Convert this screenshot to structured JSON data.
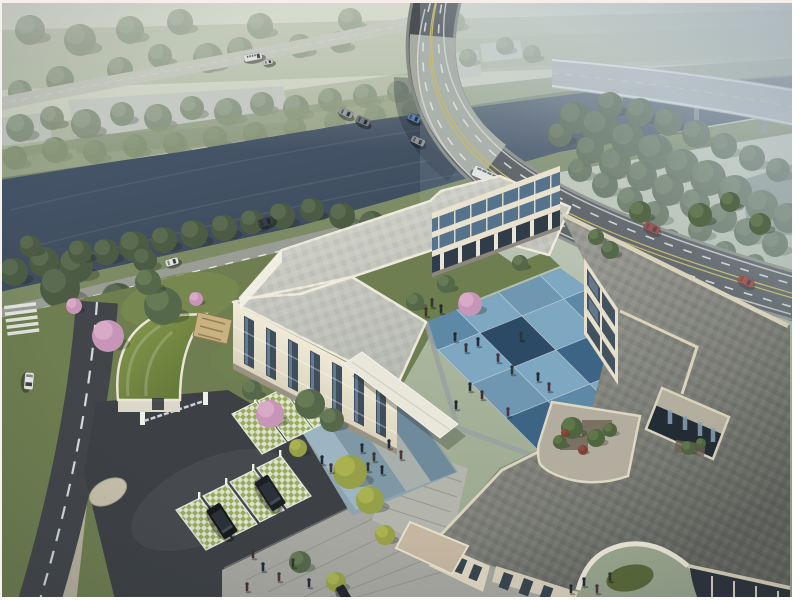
{
  "meta": {
    "alt": "Aerial daytime architectural rendering: cream three-storey U-shaped building complex around a blue checkerboard courtyard with roof terraces and a square atrium, landscaped gated entrance with grass-grid parking and black SUVs, tree-lined river crossed by a traffic bridge, curved elevated expressway fading into haze",
    "image_type": "photorealistic 3D rendering",
    "frame_color": "#ffffff"
  },
  "palette": {
    "sky_top": "#d8dacd",
    "haze": "#bccbd6",
    "water": "#45556a",
    "tree_green": "#57684b",
    "tree_dark": "#46563e",
    "tree_hazy": "#7b8b74",
    "tree_yellow": "#96a048",
    "blossom_pink": "#cc9cbd",
    "lawn": "#6e7e50",
    "asphalt_dark": "#3d4145",
    "road_asphalt": "#4c5053",
    "bridge_deck": "#a7aba3",
    "road_line_yellow": "#c9b84e",
    "road_line_white": "#e8e9e5",
    "building_cream": "#e8e2cf",
    "roof_west": "#c9cbc2",
    "roof_right": "#8e908a",
    "parapet_cream": "#dad4be",
    "window_glass": "#3f4e5c",
    "window_blue": "#7fa0b6",
    "court_blue_light": "#7ea7c2",
    "court_blue_mid": "#5d89a6",
    "court_blue_deep": "#3c6484",
    "court_blue_navy": "#2c4a66",
    "court_blue_steel": "#6f97b2",
    "plaza_grey": "#a6a7a0",
    "lattice_green": "#9db060",
    "suv_black": "#17191d",
    "car_red": "#982e24"
  },
  "scene": {
    "courtyard": {
      "origin": [
        404,
        316
      ],
      "step_ne": [
        42,
        -17
      ],
      "step_se": [
        34,
        34
      ],
      "rows": [
        [
          "M",
          "L",
          "S",
          "L",
          "D"
        ],
        [
          "L",
          "N",
          "L",
          "M",
          "L"
        ],
        [
          "S",
          "L",
          "D",
          "L",
          "M"
        ],
        [
          "D",
          "M",
          "L",
          "N",
          "L"
        ]
      ]
    },
    "trees": {
      "hazy": [
        [
          20,
          128,
          14
        ],
        [
          52,
          118,
          12
        ],
        [
          86,
          124,
          15
        ],
        [
          122,
          114,
          12
        ],
        [
          158,
          118,
          14
        ],
        [
          192,
          108,
          12
        ],
        [
          228,
          112,
          14
        ],
        [
          262,
          104,
          12
        ],
        [
          296,
          108,
          13
        ],
        [
          330,
          100,
          12
        ],
        [
          365,
          96,
          12
        ],
        [
          398,
          92,
          11
        ],
        [
          15,
          158,
          12
        ],
        [
          55,
          150,
          13
        ],
        [
          95,
          152,
          12
        ],
        [
          135,
          146,
          12
        ],
        [
          175,
          144,
          12
        ],
        [
          215,
          138,
          12
        ],
        [
          255,
          134,
          12
        ],
        [
          295,
          128,
          11
        ],
        [
          335,
          122,
          11
        ],
        [
          375,
          116,
          11
        ],
        [
          412,
          110,
          10
        ],
        [
          440,
          64,
          10
        ],
        [
          468,
          58,
          9
        ],
        [
          208,
          58,
          15
        ],
        [
          240,
          50,
          13
        ],
        [
          120,
          70,
          13
        ],
        [
          60,
          80,
          14
        ],
        [
          160,
          56,
          12
        ],
        [
          20,
          92,
          12
        ],
        [
          300,
          46,
          12
        ],
        [
          340,
          42,
          11
        ],
        [
          505,
          46,
          9
        ],
        [
          532,
          54,
          9
        ],
        [
          80,
          40,
          16
        ],
        [
          130,
          30,
          14
        ],
        [
          260,
          26,
          13
        ],
        [
          350,
          20,
          12
        ],
        [
          30,
          30,
          15
        ],
        [
          180,
          22,
          13
        ],
        [
          420,
          30,
          11
        ],
        [
          455,
          22,
          10
        ]
      ],
      "grove": [
        [
          575,
          118,
          16
        ],
        [
          600,
          128,
          18
        ],
        [
          628,
          140,
          17
        ],
        [
          655,
          152,
          18
        ],
        [
          682,
          166,
          17
        ],
        [
          708,
          178,
          18
        ],
        [
          735,
          192,
          17
        ],
        [
          762,
          206,
          16
        ],
        [
          788,
          218,
          15
        ],
        [
          590,
          150,
          14
        ],
        [
          615,
          164,
          16
        ],
        [
          642,
          176,
          15
        ],
        [
          668,
          190,
          16
        ],
        [
          695,
          204,
          15
        ],
        [
          722,
          218,
          15
        ],
        [
          748,
          232,
          14
        ],
        [
          775,
          244,
          13
        ],
        [
          610,
          105,
          13
        ],
        [
          640,
          112,
          14
        ],
        [
          668,
          122,
          14
        ],
        [
          696,
          134,
          14
        ],
        [
          724,
          146,
          13
        ],
        [
          752,
          158,
          13
        ],
        [
          778,
          170,
          12
        ],
        [
          560,
          135,
          12
        ],
        [
          580,
          170,
          12
        ],
        [
          605,
          185,
          13
        ],
        [
          630,
          200,
          13
        ],
        [
          656,
          214,
          13
        ],
        [
          590,
          222,
          12
        ],
        [
          615,
          235,
          12
        ],
        [
          700,
          230,
          12
        ],
        [
          670,
          240,
          11
        ],
        [
          725,
          252,
          11
        ],
        [
          755,
          264,
          10
        ]
      ],
      "avenue": [
        [
          14,
          272,
          14
        ],
        [
          44,
          262,
          15
        ],
        [
          76,
          266,
          17
        ],
        [
          106,
          252,
          13
        ],
        [
          134,
          246,
          15
        ],
        [
          164,
          240,
          13
        ],
        [
          194,
          234,
          14
        ],
        [
          224,
          228,
          13
        ],
        [
          252,
          222,
          12
        ],
        [
          282,
          216,
          13
        ],
        [
          312,
          210,
          12
        ],
        [
          342,
          216,
          13
        ],
        [
          372,
          224,
          13
        ],
        [
          402,
          232,
          12
        ],
        [
          428,
          242,
          11
        ],
        [
          60,
          288,
          20
        ],
        [
          118,
          300,
          17
        ],
        [
          80,
          252,
          12
        ],
        [
          30,
          246,
          11
        ],
        [
          145,
          260,
          12
        ]
      ],
      "site": [
        [
          163,
          306,
          19
        ],
        [
          148,
          282,
          13
        ],
        [
          310,
          404,
          15
        ],
        [
          332,
          420,
          12
        ],
        [
          252,
          390,
          10
        ],
        [
          415,
          302,
          9
        ],
        [
          446,
          284,
          9
        ],
        [
          520,
          263,
          8
        ],
        [
          300,
          562,
          11
        ],
        [
          610,
          250,
          9
        ],
        [
          640,
          212,
          11
        ],
        [
          700,
          215,
          12
        ],
        [
          596,
          237,
          8
        ],
        [
          730,
          202,
          10
        ],
        [
          760,
          224,
          11
        ]
      ],
      "yellow": [
        [
          350,
          472,
          17
        ],
        [
          370,
          500,
          14
        ],
        [
          336,
          582,
          10
        ],
        [
          298,
          448,
          9
        ],
        [
          385,
          535,
          10
        ]
      ],
      "pink": [
        [
          108,
          336,
          16
        ],
        [
          270,
          414,
          14
        ],
        [
          470,
          304,
          12
        ],
        [
          74,
          306,
          8
        ],
        [
          196,
          299,
          7
        ]
      ],
      "roof": [
        [
          572,
          428,
          11
        ],
        [
          596,
          438,
          9
        ],
        [
          560,
          442,
          7
        ],
        [
          610,
          430,
          7
        ],
        [
          688,
          448,
          7
        ],
        [
          701,
          443,
          5
        ]
      ],
      "roof_red": [
        [
          583,
          450,
          5
        ],
        [
          565,
          433,
          4
        ]
      ]
    },
    "people": {
      "courtyard": [
        [
          455,
          341
        ],
        [
          466,
          352
        ],
        [
          478,
          346
        ],
        [
          498,
          362
        ],
        [
          512,
          374
        ],
        [
          470,
          391
        ],
        [
          482,
          399
        ],
        [
          456,
          409
        ],
        [
          508,
          416
        ],
        [
          432,
          307
        ],
        [
          441,
          313
        ],
        [
          426,
          316
        ],
        [
          538,
          381
        ],
        [
          549,
          391
        ],
        [
          521,
          340
        ]
      ],
      "sports_court": [
        [
          362,
          452
        ],
        [
          374,
          461
        ],
        [
          389,
          448
        ],
        [
          401,
          459
        ],
        [
          368,
          471
        ],
        [
          382,
          474
        ]
      ],
      "south_plaza": [
        [
          253,
          558
        ],
        [
          263,
          571
        ],
        [
          279,
          581
        ],
        [
          293,
          567
        ],
        [
          309,
          587
        ],
        [
          247,
          591
        ],
        [
          584,
          586
        ],
        [
          597,
          593
        ],
        [
          610,
          581
        ],
        [
          571,
          593
        ]
      ],
      "entry": [
        [
          331,
          472
        ],
        [
          322,
          464
        ]
      ]
    },
    "vehicles": {
      "far": [
        [
          "bus",
          487,
          176,
          24,
          30,
          11,
          "#e9eae6"
        ],
        [
          "car",
          551,
          181,
          24,
          15,
          8,
          "#dde0df"
        ],
        [
          "car",
          346,
          113,
          24,
          14,
          7,
          "#9aa0a6"
        ],
        [
          "car",
          363,
          121,
          24,
          14,
          7,
          "#767c85"
        ],
        [
          "car",
          414,
          118,
          24,
          13,
          7,
          "#5d7fa8"
        ],
        [
          "car",
          418,
          141,
          24,
          14,
          7,
          "#8e9499"
        ],
        [
          "car",
          652,
          228,
          26,
          16,
          8,
          "#982e24"
        ],
        [
          "car",
          746,
          281,
          27,
          16,
          8,
          "#a03027"
        ],
        [
          "bus",
          253,
          57,
          -11,
          18,
          7,
          "#e4e5e0"
        ],
        [
          "car",
          268,
          62,
          -11,
          10,
          5,
          "#cdd0ca"
        ],
        [
          "car",
          266,
          222,
          -17,
          15,
          8,
          "#3a3f45"
        ],
        [
          "car",
          172,
          262,
          -17,
          13,
          7,
          "#e4e4df"
        ]
      ],
      "near": [
        [
          "van",
          29,
          381,
          95,
          17,
          9,
          "#e8e9e5"
        ],
        [
          "suv",
          222,
          521,
          57,
          34,
          16,
          "#17191d"
        ],
        [
          "suv",
          270,
          493,
          57,
          34,
          16,
          "#1b1e23"
        ],
        [
          "car",
          344,
          594,
          60,
          18,
          9,
          "#24272b"
        ]
      ]
    },
    "parking": {
      "upper_bays": [
        [
          232,
          414
        ],
        [
          258,
          401
        ],
        [
          284,
          388
        ]
      ],
      "lower_bays": [
        [
          176,
          510
        ],
        [
          203,
          496
        ],
        [
          230,
          482
        ],
        [
          257,
          468
        ]
      ]
    }
  }
}
